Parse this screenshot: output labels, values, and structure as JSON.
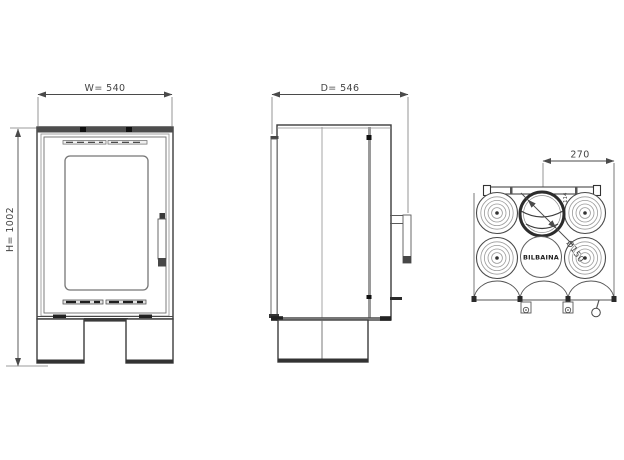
{
  "front_view": {
    "width_label": "W= 540",
    "height_label": "H= 1002"
  },
  "side_view": {
    "depth_label": "D= 546"
  },
  "top_view": {
    "offset_label": "270",
    "flue_label": "Ø150",
    "collar_label": "114",
    "brand": "BILBAINA"
  },
  "colors": {
    "line": "#3c3c3c",
    "dark_accent": "#1f1f1f",
    "light_line": "#8f8f8f",
    "background": "#ffffff"
  }
}
